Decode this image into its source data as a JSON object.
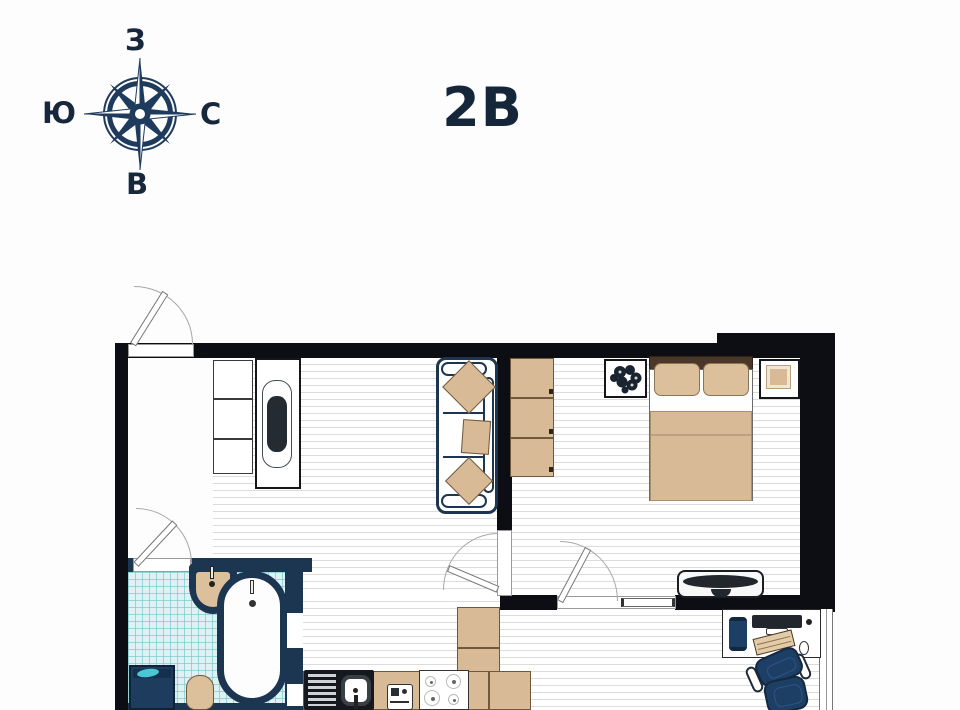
{
  "header": {
    "title": "2В"
  },
  "compass": {
    "labels": {
      "top": "З",
      "right": "С",
      "bottom": "В",
      "left": "Ю"
    },
    "color": "#1e3a5c"
  },
  "plan": {
    "palette": {
      "wall": "#0c0e13",
      "bath_wall": "#1c3551",
      "navy_furniture": "#1d3a5c",
      "beige": "#d8ba96",
      "beige_outline": "#70583d",
      "floor_line": "#dcdcdc",
      "tile_bg": "#def2f3",
      "tile_line": "#a6d8dc",
      "headboard": "#4a372a",
      "teal_accent": "#49c7d4",
      "chair": "#1d3f66"
    },
    "rooms": [
      {
        "id": "hallway",
        "floor": "white"
      },
      {
        "id": "living-room",
        "floor": "laminate"
      },
      {
        "id": "bedroom",
        "floor": "laminate"
      },
      {
        "id": "bathroom",
        "floor": "tile"
      },
      {
        "id": "kitchen-zone",
        "floor": "laminate"
      },
      {
        "id": "workspace",
        "floor": "laminate"
      }
    ],
    "furniture": [
      "shelf-unit",
      "tv-console",
      "sofa-with-three-pillows",
      "wardrobe-three-doors",
      "wall-plant-frame",
      "double-bed-two-pillows",
      "bedside-frame",
      "bedroom-tv-console",
      "kitchen-counter-l-shape",
      "kitchen-sink-with-drainboard",
      "small-appliance",
      "stove-four-burners",
      "bathroom-sink",
      "bathtub",
      "washing-machine",
      "toilet",
      "desk",
      "monitor",
      "keyboard",
      "mouse",
      "desk-accessory",
      "office-chair"
    ],
    "doors": [
      "entrance-door",
      "bathroom-door",
      "living-bedroom-door",
      "bedroom-double-door"
    ],
    "windows": [
      "workspace-window"
    ]
  }
}
